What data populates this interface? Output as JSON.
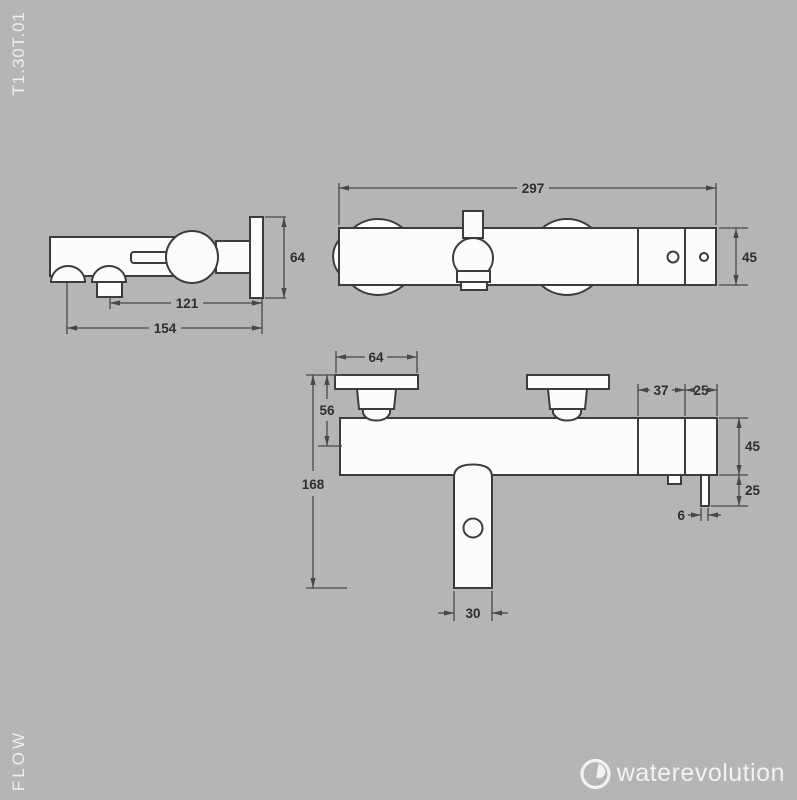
{
  "labels": {
    "product_code": "T1.30T.01",
    "brand": "FLOW",
    "logo": "waterevolution"
  },
  "colors": {
    "background": "#b3b5b7",
    "outline": "#3a3c3e",
    "dimension_lines": "#46484a",
    "dimension_text": "#2d2f31",
    "drawing_fill": "#fcfcfd",
    "light_text": "#edeff1"
  },
  "views": {
    "side": {
      "dims": {
        "plate_height": "64",
        "diverter_to_wall": "121",
        "spout_to_wall": "154"
      }
    },
    "top": {
      "dims": {
        "total_width": "297",
        "depth": "45"
      }
    },
    "front": {
      "dims": {
        "handle_width": "64",
        "handle_height": "56",
        "total_height": "168",
        "inlet_spacing": "37",
        "inlet_to_edge": "25",
        "body_height": "45",
        "outlet_length": "25",
        "outlet_width": "6",
        "spout_width": "30"
      }
    }
  }
}
